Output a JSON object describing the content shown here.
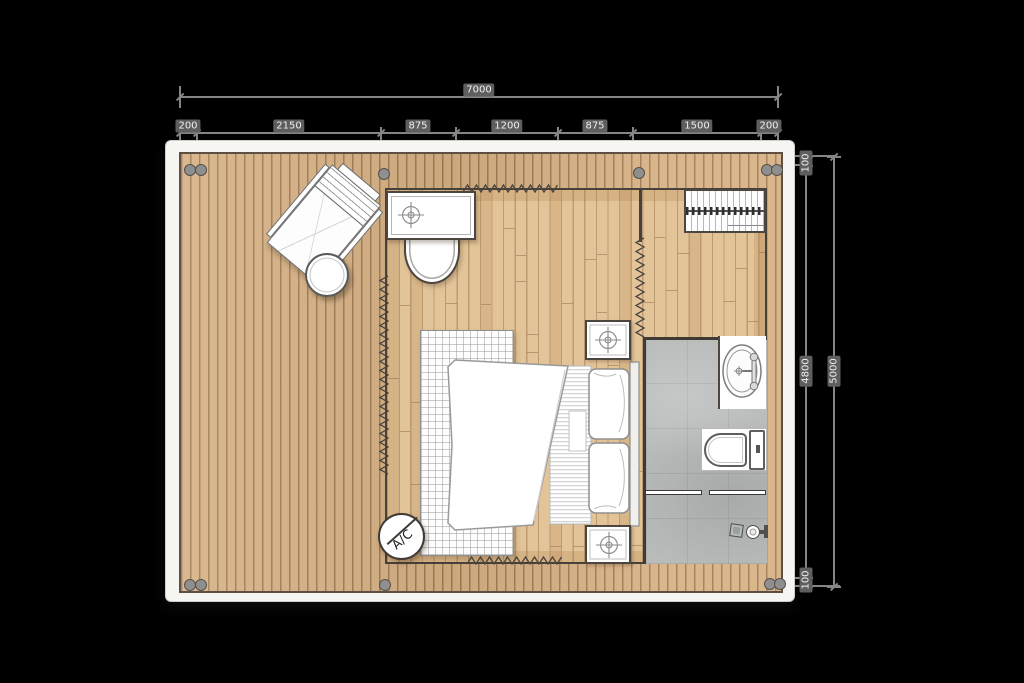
{
  "dimensions": {
    "overall_width": "7000",
    "width_segments": [
      "200",
      "2150",
      "875",
      "1200",
      "875",
      "1500",
      "200"
    ],
    "side_segments": [
      "100",
      "4800",
      "100"
    ],
    "overall_height": "5000"
  },
  "labels": {
    "ac": "A/C"
  },
  "fixtures": [
    "lounge-chair",
    "round-side-table",
    "vanity-desk",
    "desk-chair",
    "clothes-wardrobe",
    "double-bed",
    "pillows",
    "area-rug",
    "nightstand-with-lamp",
    "washbasin",
    "toilet",
    "shower",
    "glass-partition",
    "floor-drain",
    "ac-unit",
    "tent-canvas-wall",
    "deck-posts"
  ],
  "colors": {
    "background": "#000000",
    "card": "#f7f5f2",
    "deck_wood": "#d6b083",
    "interior_wood": "#e3c498",
    "bathroom_tile": "#b9bcbb",
    "wall": "#46413a",
    "dimension_line": "#858585",
    "fixture_white": "#ffffff"
  }
}
